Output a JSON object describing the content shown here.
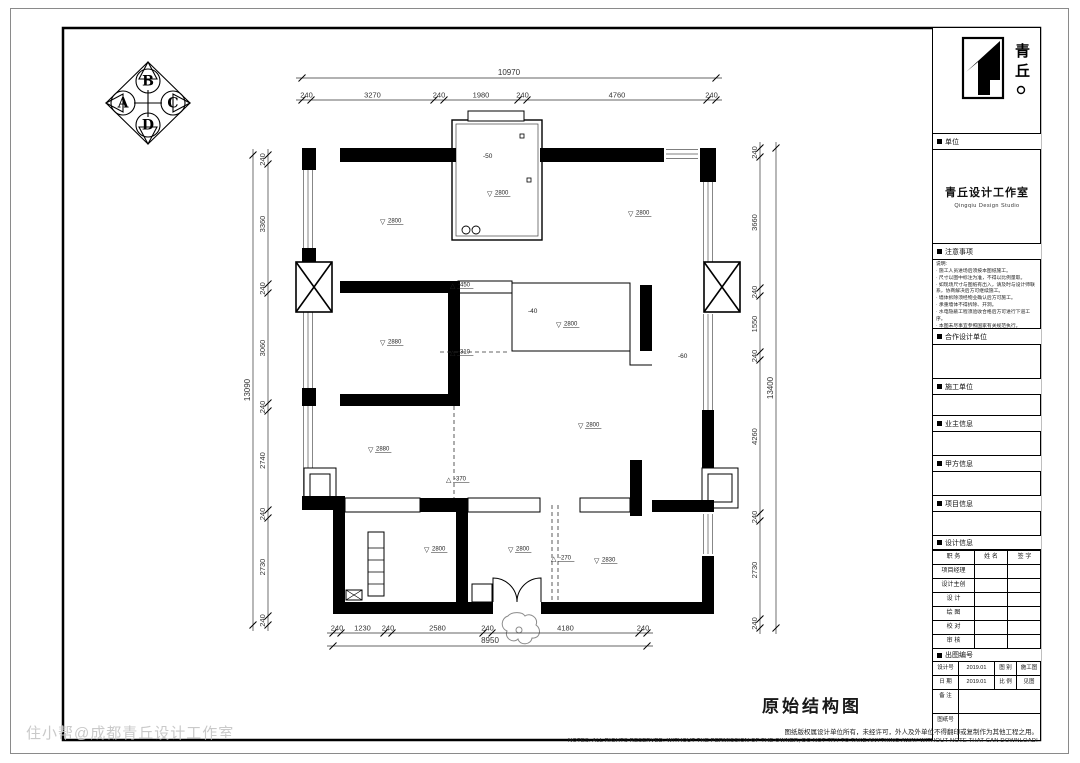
{
  "compass": {
    "letters": [
      "A",
      "B",
      "C",
      "D"
    ]
  },
  "dims": {
    "top": {
      "overall": "10970",
      "segments": [
        "240",
        "3270",
        "240",
        "1980",
        "240",
        "4760",
        "240"
      ]
    },
    "bottom": {
      "overall": "8950",
      "segments": [
        "240",
        "1230",
        "240",
        "2580",
        "240",
        "4180",
        "240"
      ]
    },
    "left": {
      "overall": "13090",
      "segments": [
        "240",
        "3360",
        "240",
        "3060",
        "240",
        "2740",
        "240",
        "2730",
        "240"
      ]
    },
    "right": {
      "overall": "13400",
      "segments": [
        "240",
        "3660",
        "240",
        "1550",
        "240",
        "4260",
        "240",
        "2730",
        "240"
      ]
    }
  },
  "plan": {
    "marks": [
      {
        "sym": "▽",
        "val": "2800",
        "x": 380,
        "y": 224
      },
      {
        "sym": "▽",
        "val": "2800",
        "x": 487,
        "y": 196
      },
      {
        "sym": "",
        "val": "-50",
        "x": 483,
        "y": 158
      },
      {
        "sym": "▽",
        "val": "2800",
        "x": 628,
        "y": 216
      },
      {
        "sym": "▽",
        "val": "2880",
        "x": 380,
        "y": 345
      },
      {
        "sym": "▽",
        "val": "2800",
        "x": 556,
        "y": 327
      },
      {
        "sym": "",
        "val": "-40",
        "x": 528,
        "y": 313
      },
      {
        "sym": "△",
        "val": "-450",
        "x": 450,
        "y": 288
      },
      {
        "sym": "△",
        "val": "-310",
        "x": 450,
        "y": 355
      },
      {
        "sym": "",
        "val": "-60",
        "x": 678,
        "y": 358
      },
      {
        "sym": "▽",
        "val": "2800",
        "x": 578,
        "y": 428
      },
      {
        "sym": "▽",
        "val": "2880",
        "x": 368,
        "y": 452
      },
      {
        "sym": "△",
        "val": "-370",
        "x": 446,
        "y": 482
      },
      {
        "sym": "▽",
        "val": "2800",
        "x": 424,
        "y": 552
      },
      {
        "sym": "▽",
        "val": "2800",
        "x": 508,
        "y": 552
      },
      {
        "sym": "△",
        "val": "-270",
        "x": 551,
        "y": 561
      },
      {
        "sym": "▽",
        "val": "2830",
        "x": 594,
        "y": 563
      }
    ]
  },
  "drawing_title": "原始结构图",
  "watermark": "住小帮@成都青丘设计工作室",
  "footer": {
    "line1": "图纸版权属设计单位所有，未经许可，外人及外单位不得翻印或复制作为其他工程之用。",
    "line2": "NOTES: ALL RIGHTS RESERVED. WITHOUT THE PERMISSION OF THE OWNER, DO NOT TRY TO TAKE ANYTHING AWAY WITHOUT NOTE THAT CAN DOWNLOAD!"
  },
  "titleblock": {
    "logo_text": "青丘。",
    "unit_label": "单位",
    "studio_cn": "青丘设计工作室",
    "studio_en": "Qingqiu Design Studio",
    "notes_label": "注意事项",
    "notes": [
      "说明:",
      "· 施工人员进场后须按本图纸施工。",
      "· 尺寸以图中标注为准，不得以比例量取。",
      "· 如现场尺寸与图纸有出入，请及时与设计师联系，协商解决后方可继续施工。",
      "· 墙体拆除须经物业确认后方可施工。",
      "· 承重墙体不得拆除、开洞。",
      "· 水电隐蔽工程须验收合格后方可进行下道工序。",
      "· 本图未尽事宜参照国家有关规范执行。"
    ],
    "coop_label": "合作设计单位",
    "builder_label": "施工单位",
    "owner_label": "业主信息",
    "party_label": "甲方信息",
    "project_label": "项目信息",
    "design_label": "设计信息",
    "design_table": {
      "headers": [
        "职 务",
        "姓 名",
        "签 字"
      ],
      "rows": [
        "项目经理",
        "设计主创",
        "设 计",
        "绘 图",
        "校 对",
        "审 核"
      ]
    },
    "sheet_label": "出图编号",
    "info": {
      "r1l1": "设计号",
      "r1v1": "2019.01",
      "r1l2": "图 别",
      "r1v2": "施工图",
      "r2l1": "日 期",
      "r2v1": "2019.01",
      "r2l2": "比 例",
      "r2v2": "见图",
      "remark": "备 注",
      "sheetno": "图纸号"
    }
  }
}
